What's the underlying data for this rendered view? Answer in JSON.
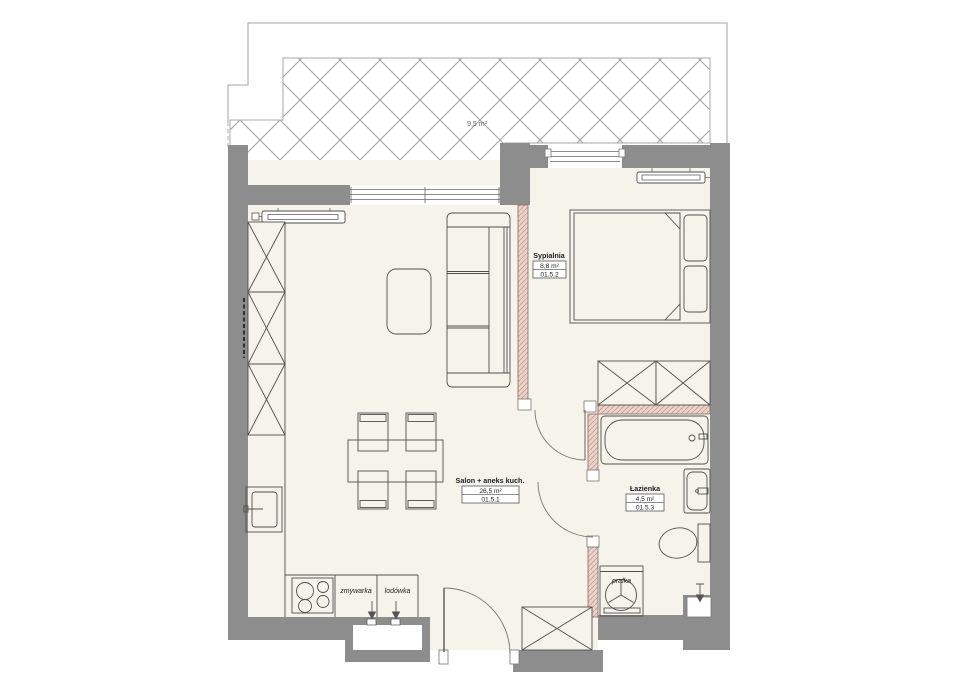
{
  "title": "Apartment floor plan 01.5",
  "terrace": {
    "area_label": "9,5 m²"
  },
  "rooms": {
    "living": {
      "name": "Salon + aneks kuch.",
      "area": "26,5 m²",
      "unit_id": "01.5.1"
    },
    "bedroom": {
      "name": "Sypialnia",
      "area": "8,8 m²",
      "unit_id": "01.5.2"
    },
    "bathroom": {
      "name": "Łazienka",
      "area": "4,5 m²",
      "unit_id": "01.5.3"
    }
  },
  "appliances": {
    "dishwasher": "zmywarka",
    "fridge": "lodówka",
    "washer": "pralka"
  },
  "colors": {
    "exterior_wall": "#8d8d8d",
    "partition_wall": "#ecd2c9",
    "partition_hatch": "#bb958c",
    "floor": "#f6f3ea",
    "terrace_hatch": "#979797",
    "furniture_line": "#4f4f4f"
  }
}
